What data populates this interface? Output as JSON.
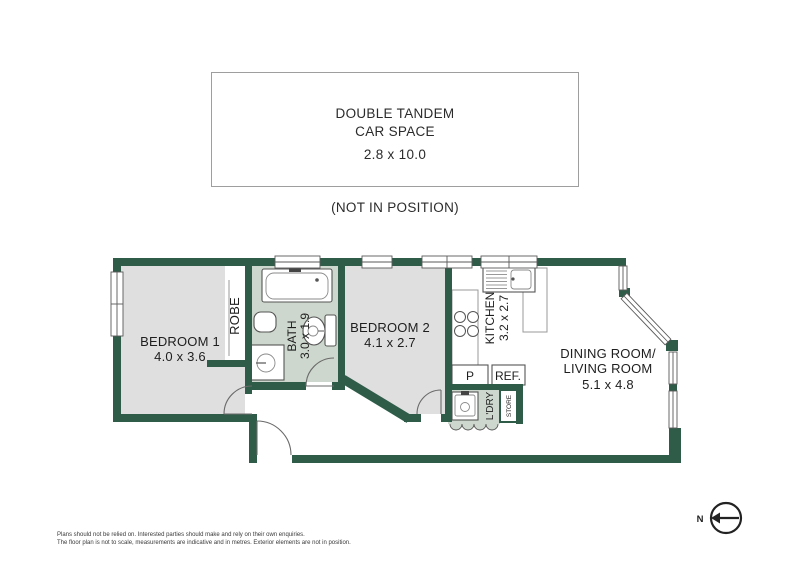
{
  "colors": {
    "wall": "#2e5c49",
    "bedroom_floor": "#dfdfdf",
    "wet_area_floor": "#cdd7cd",
    "fixture_outline": "#555555",
    "text": "#1e1e1e",
    "carspace_border": "#9e9e9e"
  },
  "car_space": {
    "title_line1": "DOUBLE TANDEM",
    "title_line2": "CAR SPACE",
    "dimensions": "2.8 x 10.0",
    "note": "(NOT IN POSITION)"
  },
  "rooms": {
    "bedroom1": {
      "label": "BEDROOM 1",
      "dimensions": "4.0 x 3.6"
    },
    "bedroom2": {
      "label": "BEDROOM 2",
      "dimensions": "4.1 x 2.7"
    },
    "bath": {
      "label": "BATH",
      "dimensions": "3.0 x 1.9"
    },
    "kitchen": {
      "label": "KITCHEN",
      "dimensions": "3.2 x 2.7"
    },
    "dining_living": {
      "label_line1": "DINING ROOM/",
      "label_line2": "LIVING ROOM",
      "dimensions": "5.1 x 4.8"
    },
    "robe": {
      "label": "ROBE"
    },
    "laundry": {
      "label": "L'DRY"
    },
    "store": {
      "label": "STORE"
    },
    "pantry": {
      "label": "P"
    },
    "fridge": {
      "label": "REF."
    }
  },
  "compass": {
    "label": "N"
  },
  "disclaimer": {
    "line1": "Plans should not be relied on. Interested parties should make and rely on their own enquiries.",
    "line2": "The floor plan is not to scale, measurements are indicative and in metres. Exterior elements are not in position."
  }
}
